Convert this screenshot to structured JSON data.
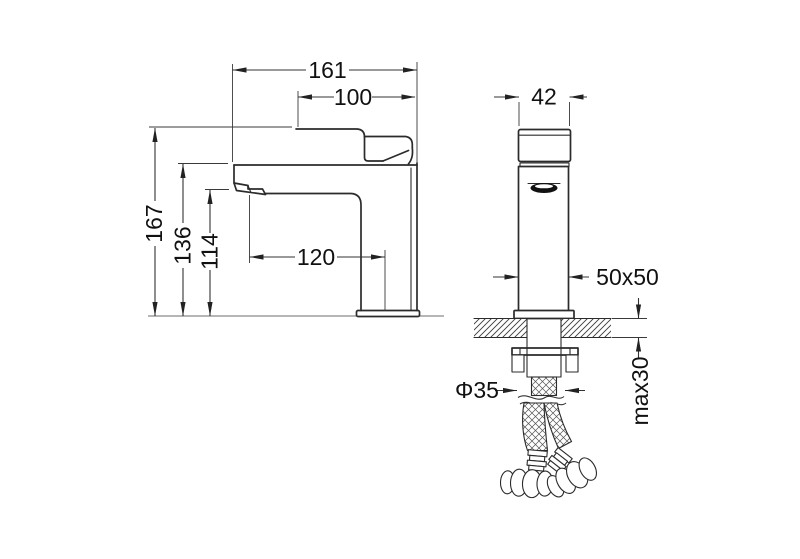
{
  "drawing": {
    "type": "faucet-installation-dimension-drawing",
    "colors": {
      "background": "#ffffff",
      "object_line": "#2b2b2b",
      "dimension_line": "#333333",
      "text": "#111111",
      "ground_line": "#8a8a8a"
    },
    "side_view": {
      "dims": {
        "overall_length": "161",
        "handle_projection": "100",
        "overall_height": "167",
        "body_top_height": "136",
        "spout_outlet_height": "114",
        "spout_reach": "120"
      }
    },
    "front_view": {
      "dims": {
        "handle_width": "42",
        "body_section": "50x50",
        "supply_hole_diameter": "Φ35",
        "max_deck_thickness": "max30"
      }
    }
  }
}
